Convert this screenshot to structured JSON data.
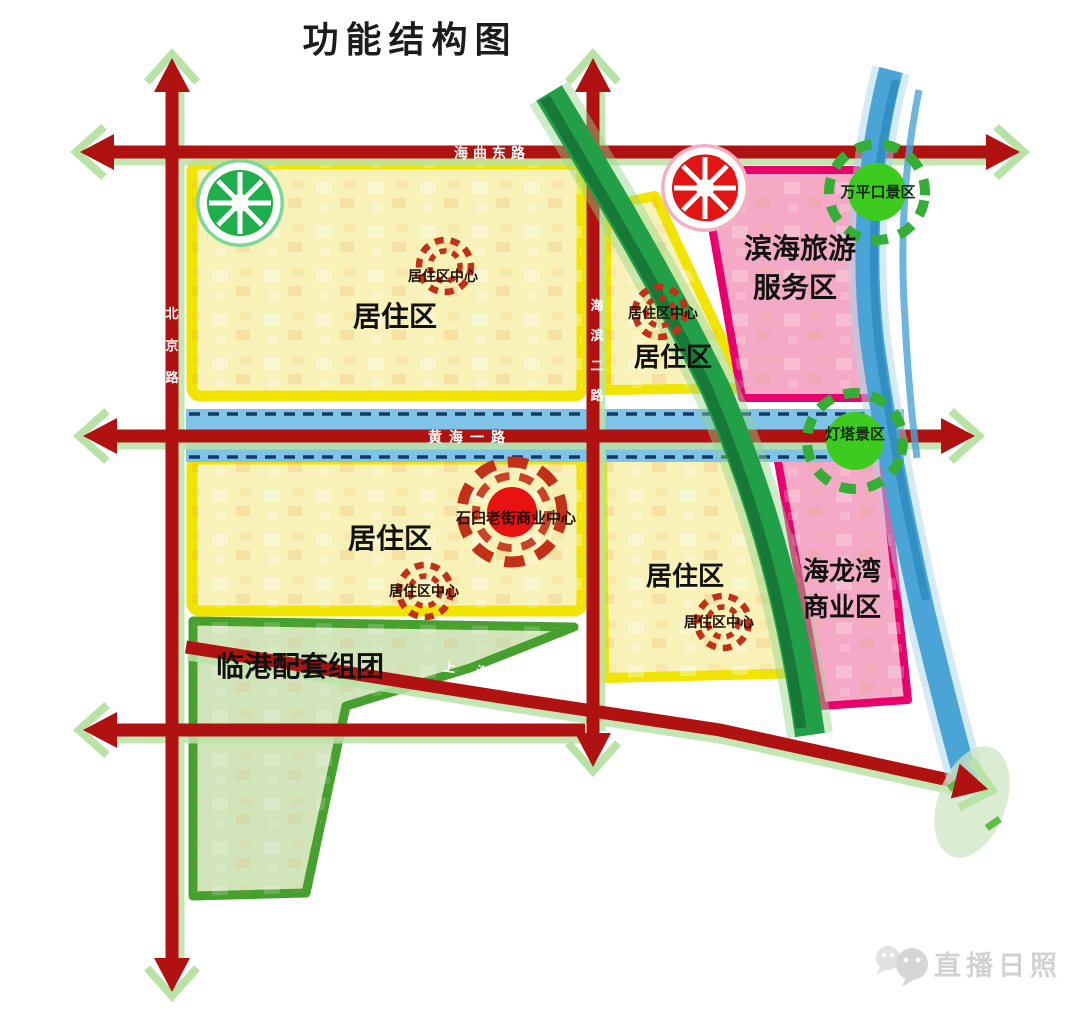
{
  "title": "功能结构图",
  "watermark": {
    "label": "直播日照",
    "icon": "wechat-icon"
  },
  "roads": {
    "haiqu_east": {
      "name": "海曲东路"
    },
    "huanghai_first": {
      "name": "黄海一路"
    },
    "shanghai": {
      "name": "上海路",
      "chars": [
        "上",
        "海",
        "路"
      ]
    },
    "beijing": {
      "name": "北京路",
      "chars": [
        "北",
        "京",
        "路"
      ]
    },
    "haibin_second": {
      "name": "海滨二路",
      "chars": [
        "海",
        "滨",
        "二",
        "路"
      ]
    }
  },
  "regions": {
    "residential_nw": {
      "label": "居住区"
    },
    "residential_ne": {
      "label": "居住区"
    },
    "residential_sw": {
      "label": "居住区"
    },
    "residential_se": {
      "label": "居住区"
    },
    "binhai_tourism": {
      "line1": "滨海旅游",
      "line2": "服务区"
    },
    "hailongwan": {
      "line1": "海龙湾",
      "line2": "商业区"
    },
    "lingang": {
      "label": "临港配套组团"
    }
  },
  "centers": {
    "residential_center_nw": {
      "label": "居住区中心"
    },
    "residential_center_ne": {
      "label": "居住区中心"
    },
    "residential_center_sw": {
      "label": "居住区中心"
    },
    "residential_center_se": {
      "label": "居住区中心"
    },
    "shijiu_old_street": {
      "label": "石臼老街商业中心"
    }
  },
  "scenic": {
    "wanpingkou": {
      "label": "万平口景区"
    },
    "lighthouse": {
      "label": "灯塔景区"
    }
  },
  "colors": {
    "road_red": "#b01212",
    "road_shadow_green": "#b9e3a6",
    "yellow_block_border": "#f0e400",
    "yellow_block_fill": "#f8f1b8",
    "pink_block_border": "#e8006e",
    "pink_block_fill": "#f4aac6",
    "green_block_border": "#46a02e",
    "green_block_fill": "#d2e4ba",
    "green_corridor": "#21a047",
    "blue_corridor": "#4aa4d6",
    "blue_band": "#7fc3e8",
    "scenic_green": "#3ecb1f",
    "center_red": "#e81212",
    "dashed_ring_red": "#c23018",
    "watermark_gray": "#d2d2d2"
  }
}
